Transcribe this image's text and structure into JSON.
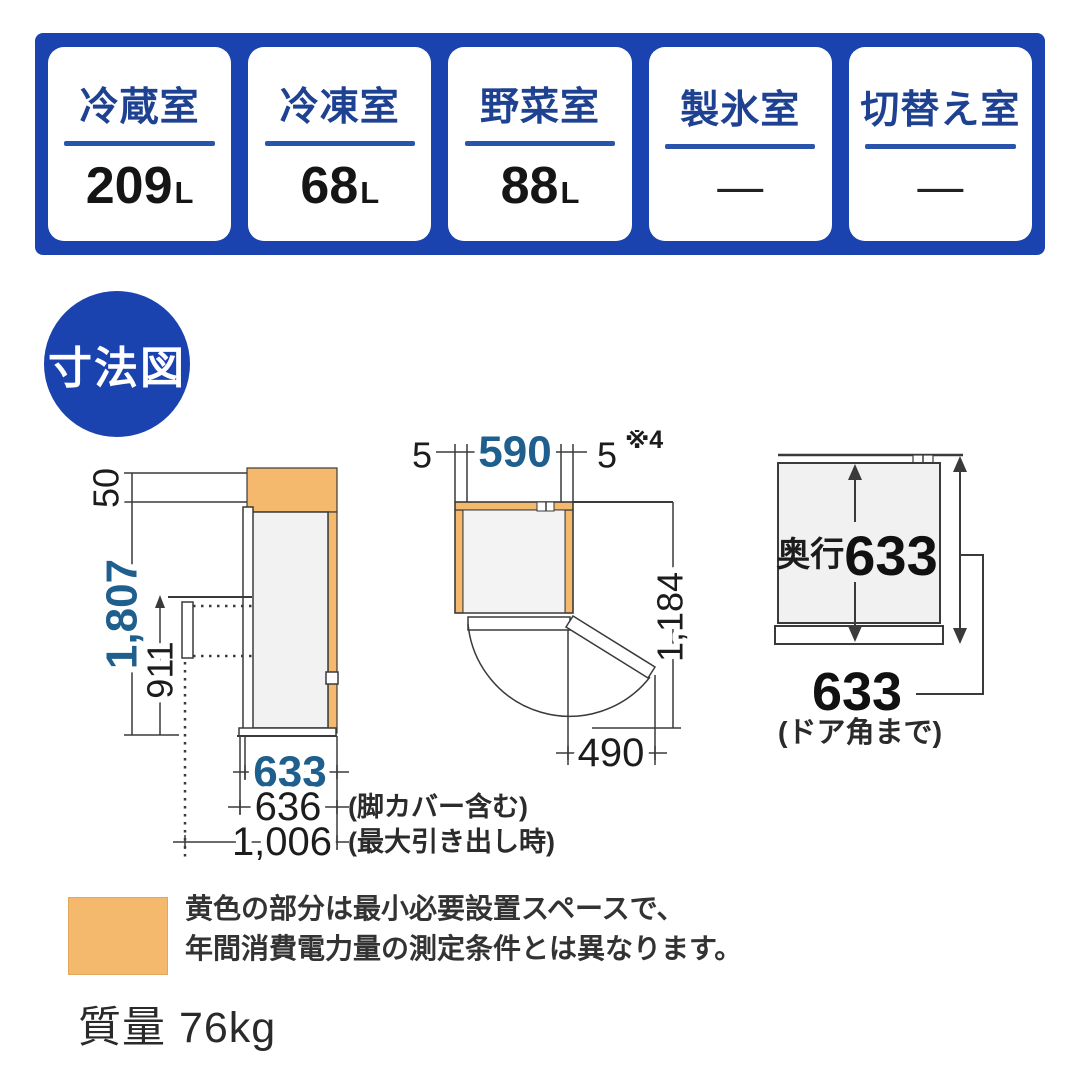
{
  "banner": {
    "cards": [
      {
        "label": "冷蔵室",
        "value": "209",
        "unit": "L"
      },
      {
        "label": "冷凍室",
        "value": "68",
        "unit": "L"
      },
      {
        "label": "野菜室",
        "value": "88",
        "unit": "L"
      },
      {
        "label": "製氷室",
        "value": "—",
        "unit": ""
      },
      {
        "label": "切替え室",
        "value": "—",
        "unit": ""
      }
    ]
  },
  "badge": {
    "label": "寸法図"
  },
  "side_view": {
    "top_clearance": "50",
    "total_height": "1,807",
    "drawer_top_height": "911",
    "depth_body": "633",
    "depth_leg_cover": "636",
    "leg_cover_note": "(脚カバー含む)",
    "depth_drawer_out": "1,006",
    "drawer_out_note": "(最大引き出し時)"
  },
  "top_view": {
    "left_gap": "5",
    "body_width": "590",
    "right_gap": "5",
    "right_gap_ref": "※4",
    "door_open_depth": "1,184",
    "door_width": "490"
  },
  "rear_view": {
    "depth_prefix": "奥行",
    "depth": "633",
    "door_corner_depth": "633",
    "door_corner_note": "(ドア角まで)"
  },
  "legend": {
    "line1": "黄色の部分は最小必要設置スペースで、",
    "line2": "年間消費電力量の測定条件とは異なります。"
  },
  "mass": {
    "label": "質量",
    "value": "76kg"
  },
  "colors": {
    "banner_blue": "#1b43b0",
    "dim_blue": "#1f5f8e",
    "space_orange": "#f5b96e"
  }
}
